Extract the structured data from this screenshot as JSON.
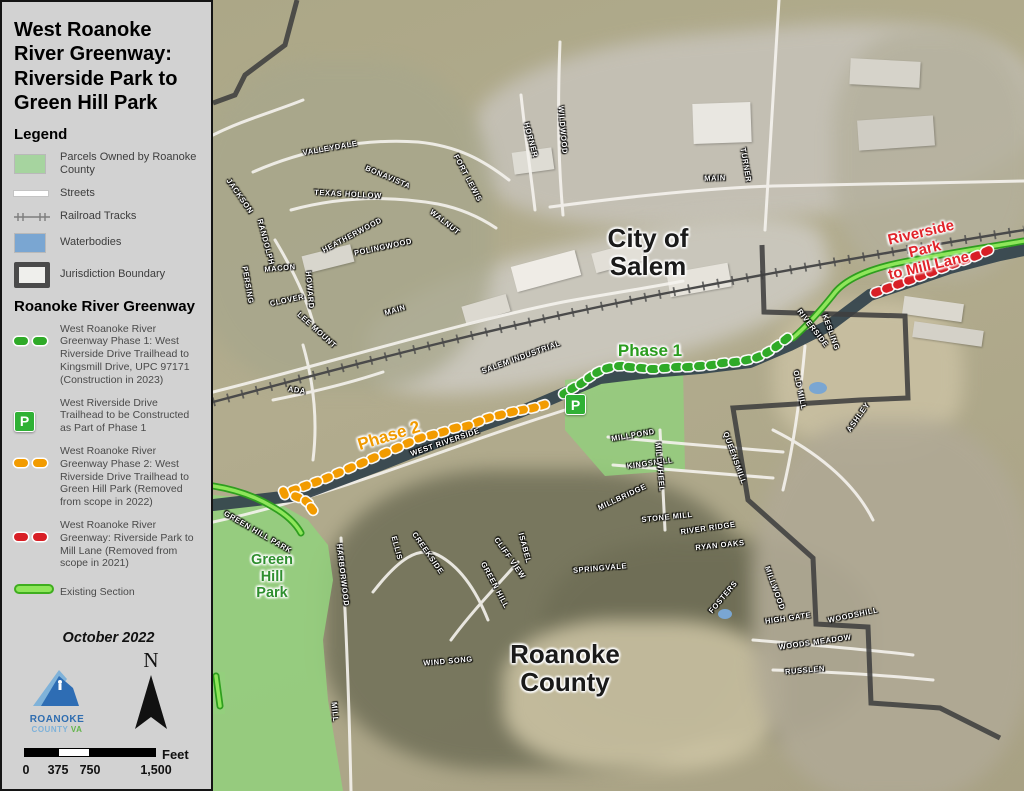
{
  "panel": {
    "title": "West Roanoke River Greenway: Riverside Park to Green Hill Park",
    "legend_heading": "Legend",
    "legend": {
      "items": [
        {
          "symbol": "parcel-swatch",
          "label": "Parcels Owned by Roanoke County"
        },
        {
          "symbol": "street-line",
          "label": "Streets"
        },
        {
          "symbol": "railroad-line",
          "label": "Railroad Tracks"
        },
        {
          "symbol": "water-swatch",
          "label": "Waterbodies"
        },
        {
          "symbol": "jurisdiction-outline",
          "label": "Jurisdiction Boundary"
        }
      ]
    },
    "greenway_heading": "Roanoke River Greenway",
    "greenway_items": [
      {
        "symbol": "green-dashes",
        "label": "West Roanoke River Greenway Phase 1: West Riverside Drive Trailhead to Kingsmill Drive, UPC 97171 (Construction in 2023)"
      },
      {
        "symbol": "trailhead-p",
        "label": "West Riverside Drive Trailhead to be Constructed as Part of Phase 1"
      },
      {
        "symbol": "orange-dashes",
        "label": "West Roanoke River Greenway Phase 2: West Riverside Drive Trailhead to Green Hill Park (Removed from scope in 2022)"
      },
      {
        "symbol": "red-dashes",
        "label": "West Roanoke River Greenway: Riverside Park to Mill Lane (Removed from scope in 2021)"
      },
      {
        "symbol": "existing-line",
        "label": "Existing Section"
      }
    ],
    "date": "October 2022",
    "logo": {
      "line1": "ROANOKE",
      "line2": "COUNTY ",
      "line2b": "VA"
    },
    "north_label": "N",
    "scale": {
      "ticks": [
        "0",
        "375",
        "750",
        "1,500"
      ],
      "unit": "Feet"
    }
  },
  "map": {
    "labels": {
      "city": "City of\nSalem",
      "county": "Roanoke\nCounty",
      "park": "Green\nHill\nPark",
      "phase1": "Phase 1",
      "phase2": "Phase 2",
      "riverside": "Riverside Park\nto Mill Lane",
      "p_marker": "P"
    },
    "colors": {
      "phase1": "#2faa28",
      "phase2": "#f29b00",
      "removed_2021": "#d81f26",
      "existing": "#8ee65a",
      "parcel": "#93cf7d",
      "water": "#7aa6d2"
    },
    "street_labels": [
      {
        "text": "VALLEYDALE",
        "x": 117,
        "y": 148,
        "r": -10
      },
      {
        "text": "BONAVISTA",
        "x": 175,
        "y": 177,
        "r": 23
      },
      {
        "text": "FORT LEWIS",
        "x": 255,
        "y": 178,
        "r": 62
      },
      {
        "text": "TEXAS HOLLOW",
        "x": 135,
        "y": 194,
        "r": 3
      },
      {
        "text": "WALNUT",
        "x": 232,
        "y": 222,
        "r": 38
      },
      {
        "text": "HEATHERWOOD",
        "x": 139,
        "y": 235,
        "r": -28
      },
      {
        "text": "POLINGWOOD",
        "x": 170,
        "y": 247,
        "r": -12
      },
      {
        "text": "JACKSON",
        "x": 27,
        "y": 196,
        "r": 55
      },
      {
        "text": "RANDOLPH",
        "x": 53,
        "y": 242,
        "r": 75
      },
      {
        "text": "PERSING",
        "x": 35,
        "y": 285,
        "r": 80
      },
      {
        "text": "MACON",
        "x": 67,
        "y": 268,
        "r": -5
      },
      {
        "text": "CLOVER",
        "x": 74,
        "y": 300,
        "r": -12
      },
      {
        "text": "HOWARD",
        "x": 97,
        "y": 290,
        "r": 85
      },
      {
        "text": "LEE MOUNT",
        "x": 104,
        "y": 330,
        "r": 42
      },
      {
        "text": "ADA",
        "x": 84,
        "y": 390,
        "r": 8
      },
      {
        "text": "MAIN",
        "x": 182,
        "y": 310,
        "r": -17
      },
      {
        "text": "SALEM INDUSTRIAL",
        "x": 308,
        "y": 357,
        "r": -20
      },
      {
        "text": "WEST RIVERSIDE",
        "x": 232,
        "y": 442,
        "r": -19
      },
      {
        "text": "MAIN",
        "x": 502,
        "y": 178,
        "r": -2
      },
      {
        "text": "TURNER",
        "x": 533,
        "y": 165,
        "r": 80
      },
      {
        "text": "WILDWOOD",
        "x": 350,
        "y": 130,
        "r": 85
      },
      {
        "text": "HORNER",
        "x": 318,
        "y": 140,
        "r": 75
      },
      {
        "text": "KESLING",
        "x": 618,
        "y": 332,
        "r": 70
      },
      {
        "text": "OLD MILL",
        "x": 587,
        "y": 390,
        "r": 78
      },
      {
        "text": "RIVERSIDE",
        "x": 600,
        "y": 328,
        "r": 52
      },
      {
        "text": "ASHLEY",
        "x": 645,
        "y": 417,
        "r": -55
      },
      {
        "text": "MILLPOND",
        "x": 420,
        "y": 435,
        "r": -10
      },
      {
        "text": "KINGSMILL",
        "x": 437,
        "y": 463,
        "r": -8
      },
      {
        "text": "MILLBRIDGE",
        "x": 409,
        "y": 497,
        "r": -25
      },
      {
        "text": "MILLWHEEL",
        "x": 447,
        "y": 467,
        "r": 85
      },
      {
        "text": "STONE MILL",
        "x": 454,
        "y": 517,
        "r": -6
      },
      {
        "text": "RIVER RIDGE",
        "x": 495,
        "y": 528,
        "r": -8
      },
      {
        "text": "RYAN OAKS",
        "x": 507,
        "y": 545,
        "r": -6
      },
      {
        "text": "QUEENSMILL",
        "x": 522,
        "y": 458,
        "r": 70
      },
      {
        "text": "CREEKSIDE",
        "x": 215,
        "y": 553,
        "r": 55
      },
      {
        "text": "ELLIS",
        "x": 184,
        "y": 548,
        "r": 75
      },
      {
        "text": "HARBORWOOD",
        "x": 130,
        "y": 575,
        "r": 83
      },
      {
        "text": "GREEN HILL",
        "x": 282,
        "y": 585,
        "r": 62
      },
      {
        "text": "CLIFF VIEW",
        "x": 297,
        "y": 558,
        "r": 55
      },
      {
        "text": "ISABEL",
        "x": 312,
        "y": 548,
        "r": 75
      },
      {
        "text": "SPRINGVALE",
        "x": 387,
        "y": 568,
        "r": -5
      },
      {
        "text": "FOSTERS",
        "x": 510,
        "y": 597,
        "r": -50
      },
      {
        "text": "MILLWOOD",
        "x": 562,
        "y": 588,
        "r": 70
      },
      {
        "text": "HIGH GATE",
        "x": 575,
        "y": 618,
        "r": -8
      },
      {
        "text": "WOODSHILL",
        "x": 640,
        "y": 615,
        "r": -12
      },
      {
        "text": "WOODS MEADOW",
        "x": 602,
        "y": 642,
        "r": -8
      },
      {
        "text": "RUSSLEN",
        "x": 592,
        "y": 670,
        "r": -5
      },
      {
        "text": "WIND SONG",
        "x": 235,
        "y": 661,
        "r": -5
      },
      {
        "text": "MILL",
        "x": 122,
        "y": 712,
        "r": 85
      },
      {
        "text": "GREEN HILL PARK",
        "x": 45,
        "y": 532,
        "r": 30
      }
    ],
    "routes": [
      {
        "name": "phase-1",
        "color": "#2faa28",
        "dots": [
          [
            352,
            393
          ],
          [
            360,
            388
          ],
          [
            369,
            383
          ],
          [
            377,
            377
          ],
          [
            385,
            372
          ],
          [
            395,
            368
          ],
          [
            407,
            366
          ],
          [
            417,
            367
          ],
          [
            429,
            368
          ],
          [
            440,
            369
          ],
          [
            452,
            368
          ],
          [
            464,
            367
          ],
          [
            475,
            367
          ],
          [
            487,
            366
          ],
          [
            499,
            365
          ],
          [
            510,
            363
          ],
          [
            522,
            362
          ],
          [
            534,
            360
          ],
          [
            545,
            357
          ],
          [
            555,
            352
          ],
          [
            564,
            346
          ],
          [
            573,
            339
          ]
        ]
      },
      {
        "name": "phase-2",
        "color": "#f29b00",
        "dots": [
          [
            330,
            405
          ],
          [
            320,
            408
          ],
          [
            309,
            410
          ],
          [
            299,
            412
          ],
          [
            287,
            415
          ],
          [
            275,
            418
          ],
          [
            265,
            422
          ],
          [
            254,
            426
          ],
          [
            242,
            428
          ],
          [
            230,
            432
          ],
          [
            219,
            435
          ],
          [
            207,
            438
          ],
          [
            195,
            443
          ],
          [
            184,
            448
          ],
          [
            172,
            453
          ],
          [
            160,
            458
          ],
          [
            149,
            463
          ],
          [
            137,
            468
          ],
          [
            125,
            473
          ],
          [
            114,
            478
          ],
          [
            103,
            482
          ],
          [
            92,
            486
          ],
          [
            81,
            490
          ],
          [
            71,
            493
          ],
          [
            84,
            497
          ],
          [
            94,
            502
          ],
          [
            99,
            509
          ]
        ]
      },
      {
        "name": "riverside-to-mill-lane",
        "color": "#d81f26",
        "dots": [
          [
            664,
            292
          ],
          [
            675,
            288
          ],
          [
            686,
            284
          ],
          [
            697,
            280
          ],
          [
            708,
            276
          ],
          [
            719,
            272
          ],
          [
            730,
            268
          ],
          [
            741,
            264
          ],
          [
            752,
            260
          ],
          [
            763,
            256
          ],
          [
            774,
            251
          ]
        ]
      }
    ]
  }
}
